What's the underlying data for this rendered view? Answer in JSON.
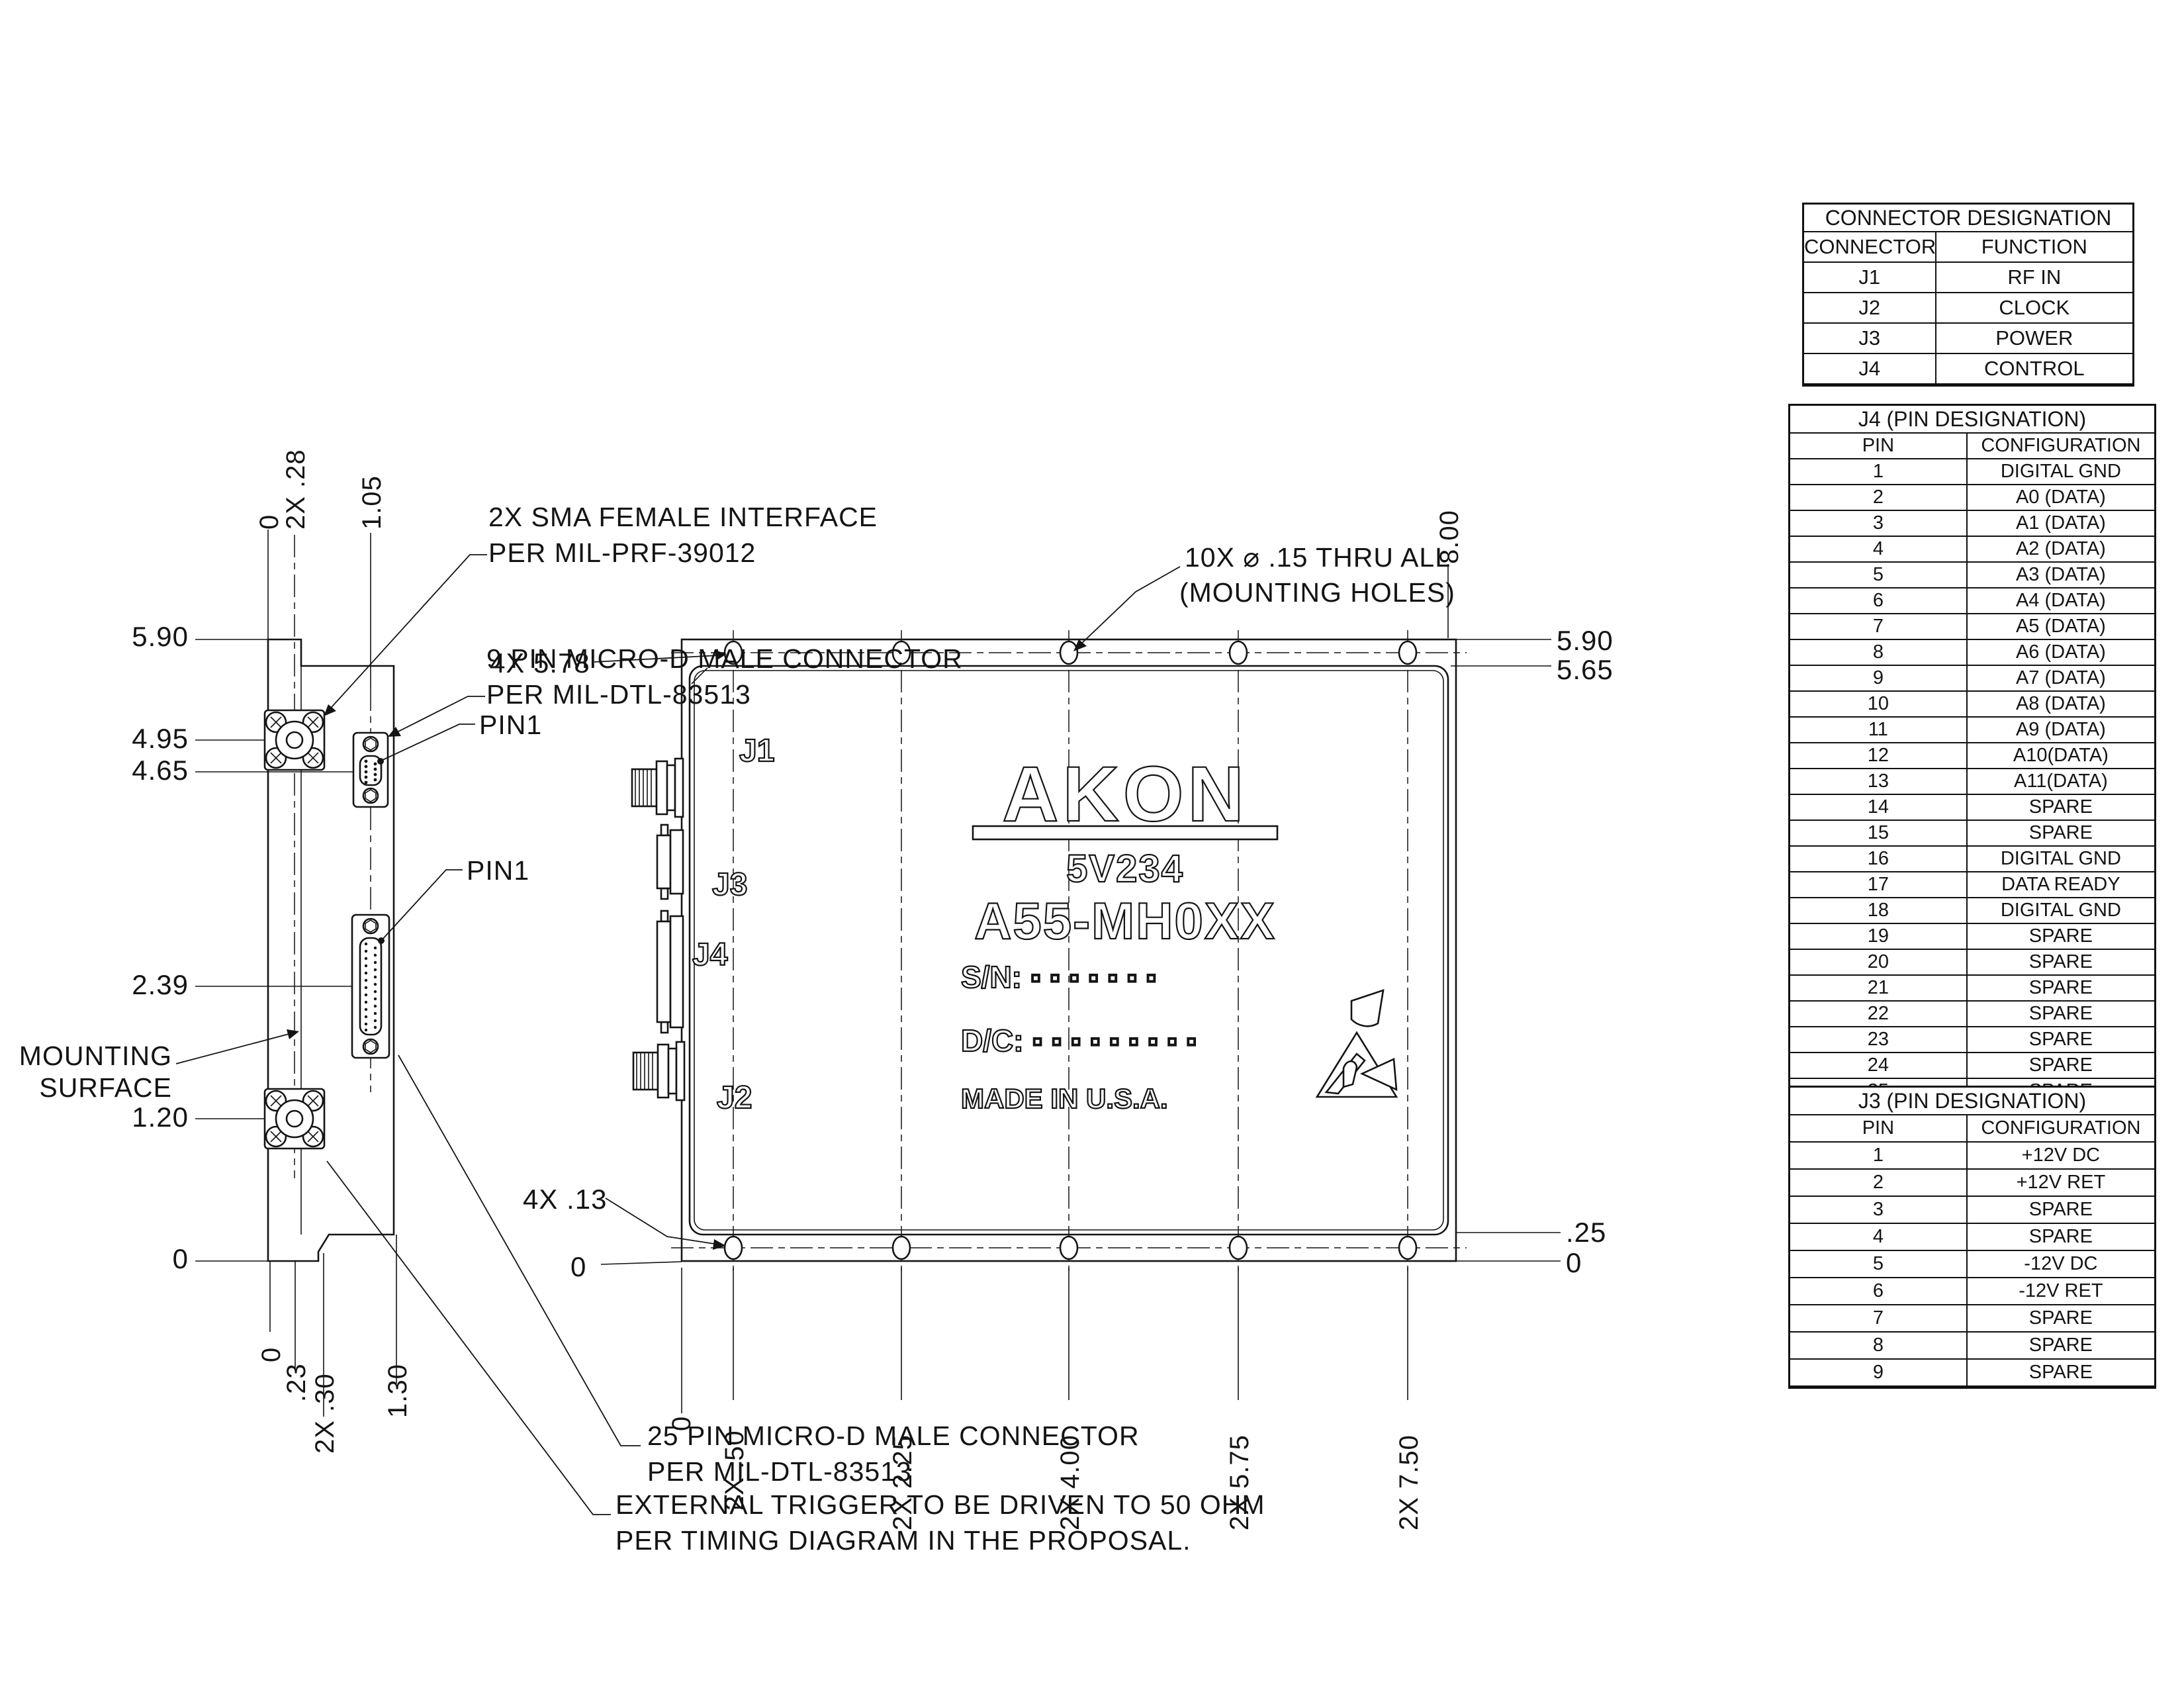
{
  "side_view": {
    "dim_590": "5.90",
    "dim_495": "4.95",
    "dim_465": "4.65",
    "dim_239": "2.39",
    "dim_120": "1.20",
    "dim_0_left": "0",
    "mounting_line1": "MOUNTING",
    "mounting_line2": "SURFACE",
    "top_dim_0": "0",
    "top_dim_28": "2X .28",
    "top_dim_105": "1.05",
    "bottom_dims": [
      "0",
      ".23",
      "2X .30",
      "1.30"
    ]
  },
  "main_view": {
    "j1": "J1",
    "j2": "J2",
    "j3": "J3",
    "j4": "J4",
    "logo": "AKON",
    "model": "5V234",
    "part": "A55-MH0XX",
    "sn": "S/N: ▫ ▫ ▫ ▫ ▫ ▫ ▫",
    "dc": "D/C: ▫ ▫ ▫ ▫ ▫ ▫ ▫ ▫ ▫",
    "made": "MADE IN U.S.A.",
    "dim_578": "4X 5.78",
    "dim_800": "8.00",
    "dim_590": "5.90",
    "dim_565": "5.65",
    "dim_025": ".25",
    "dim_0_right": "0",
    "dim_013": "4X .13",
    "dim_0_bl": "0",
    "bottom_dims": [
      "0",
      "2X .50",
      "2X 2.25",
      "2X 4.00",
      "2X 5.75",
      "2X 7.50"
    ]
  },
  "callouts": {
    "sma_line1": "2X SMA FEMALE INTERFACE",
    "sma_line2": "PER MIL-PRF-39012",
    "dsub9_line1": "9 PIN MICRO-D MALE CONNECTOR",
    "dsub9_line2": "PER MIL-DTL-83513",
    "holes_line1": "10X  ⌀ .15 THRU ALL",
    "holes_line2": "(MOUNTING HOLES)",
    "dsub25_line1": "25 PIN MICRO-D MALE CONNECTOR",
    "dsub25_line2": "PER MIL-DTL-83513",
    "trigger_line1": "EXTERNAL TRIGGER TO BE DRIVEN TO 50 OHM",
    "trigger_line2": "PER TIMING DIAGRAM IN THE PROPOSAL.",
    "pin1": "PIN1"
  },
  "tables": {
    "connector": {
      "title": "CONNECTOR DESIGNATION",
      "col1": "CONNECTOR",
      "col2": "FUNCTION",
      "rows": [
        {
          "c": "J1",
          "f": "RF IN"
        },
        {
          "c": "J2",
          "f": "CLOCK"
        },
        {
          "c": "J3",
          "f": "POWER"
        },
        {
          "c": "J4",
          "f": "CONTROL"
        }
      ]
    },
    "j4": {
      "title": "J4 (PIN DESIGNATION)",
      "col1": "PIN",
      "col2": "CONFIGURATION",
      "rows": [
        {
          "c": "1",
          "f": "DIGITAL GND"
        },
        {
          "c": "2",
          "f": "A0 (DATA)"
        },
        {
          "c": "3",
          "f": "A1 (DATA)"
        },
        {
          "c": "4",
          "f": "A2 (DATA)"
        },
        {
          "c": "5",
          "f": "A3 (DATA)"
        },
        {
          "c": "6",
          "f": "A4 (DATA)"
        },
        {
          "c": "7",
          "f": "A5 (DATA)"
        },
        {
          "c": "8",
          "f": "A6 (DATA)"
        },
        {
          "c": "9",
          "f": "A7 (DATA)"
        },
        {
          "c": "10",
          "f": "A8 (DATA)"
        },
        {
          "c": "11",
          "f": "A9 (DATA)"
        },
        {
          "c": "12",
          "f": "A10(DATA)"
        },
        {
          "c": "13",
          "f": "A11(DATA)"
        },
        {
          "c": "14",
          "f": "SPARE"
        },
        {
          "c": "15",
          "f": "SPARE"
        },
        {
          "c": "16",
          "f": "DIGITAL GND"
        },
        {
          "c": "17",
          "f": "DATA READY"
        },
        {
          "c": "18",
          "f": "DIGITAL GND"
        },
        {
          "c": "19",
          "f": "SPARE"
        },
        {
          "c": "20",
          "f": "SPARE"
        },
        {
          "c": "21",
          "f": "SPARE"
        },
        {
          "c": "22",
          "f": "SPARE"
        },
        {
          "c": "23",
          "f": "SPARE"
        },
        {
          "c": "24",
          "f": "SPARE"
        },
        {
          "c": "25",
          "f": "SPARE"
        }
      ]
    },
    "j3": {
      "title": "J3 (PIN DESIGNATION)",
      "col1": "PIN",
      "col2": "CONFIGURATION",
      "rows": [
        {
          "c": "1",
          "f": "+12V DC"
        },
        {
          "c": "2",
          "f": "+12V RET"
        },
        {
          "c": "3",
          "f": "SPARE"
        },
        {
          "c": "4",
          "f": "SPARE"
        },
        {
          "c": "5",
          "f": "-12V DC"
        },
        {
          "c": "6",
          "f": "-12V RET"
        },
        {
          "c": "7",
          "f": "SPARE"
        },
        {
          "c": "8",
          "f": "SPARE"
        },
        {
          "c": "9",
          "f": "SPARE"
        }
      ]
    }
  }
}
